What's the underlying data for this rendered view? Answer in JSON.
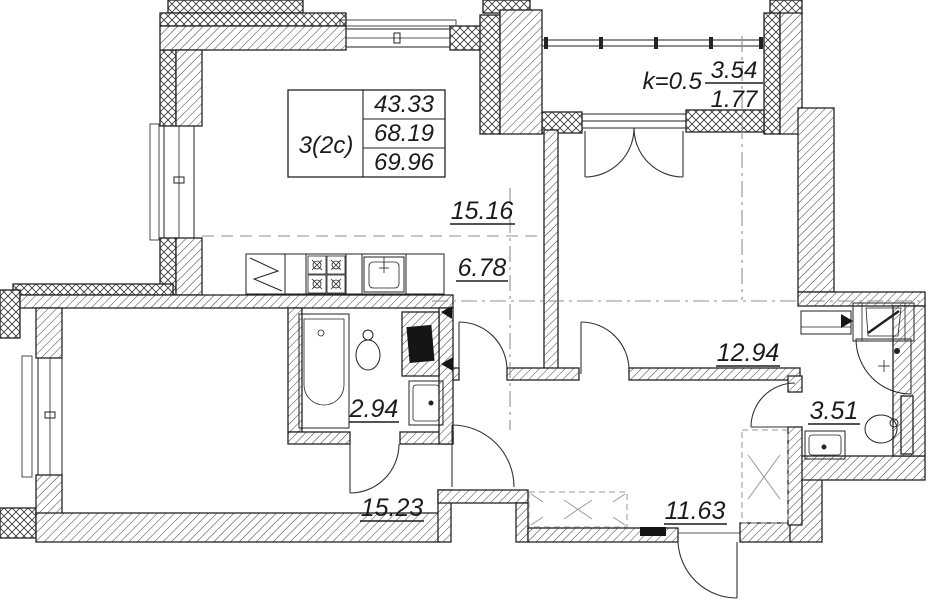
{
  "drawing": {
    "unit_table": {
      "type": "3(2c)",
      "rows": [
        "43.33",
        "68.19",
        "69.96"
      ]
    },
    "balcony": {
      "coef": "k=0.5",
      "num": "3.54",
      "den": "1.77"
    },
    "rooms": {
      "living": "15.16",
      "hall": "6.78",
      "bedroom2": "12.94",
      "bath_small": "2.94",
      "bath_main": "3.51",
      "bedroom1": "15.23",
      "entry": "11.63"
    },
    "colors": {
      "line": "#1b1b1b",
      "axis": "#8f8f8f",
      "bg": "#ffffff"
    }
  }
}
